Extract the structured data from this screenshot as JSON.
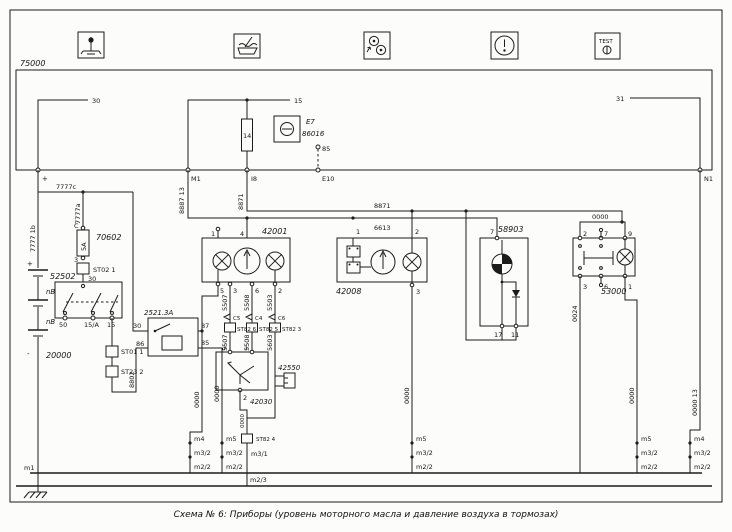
{
  "caption": "Схема № 6: Приборы (уровень моторного масла и давление воздуха в тормозах)",
  "icons": {
    "test_label": "TEST"
  },
  "top": {
    "box_id": "75000",
    "w30": "30",
    "w15": "15",
    "w31": "31",
    "fuse14": "14",
    "e7": "E7",
    "e7_code": "86016",
    "e7_pin": "85",
    "t_plus": "+",
    "t_m1": "M1",
    "t_i8": "I8",
    "t_e10": "E10",
    "t_n1": "N1"
  },
  "wires": {
    "rail": "7777c",
    "rail_left": "7777 1b",
    "rail_right": "7777a",
    "w8887": "8887 13",
    "w8871v": "8871",
    "w8871": "8871",
    "w6613": "6613",
    "w8802": "8802",
    "w0024": "0024",
    "right0000": "0000 13",
    "gnd": "0000"
  },
  "fuse70602": {
    "id": "70602",
    "amp": "5A",
    "c": "C",
    "p3": "3",
    "st02": "ST02 1",
    "p30": "30"
  },
  "sw52502": {
    "id": "52502",
    "p50": "50",
    "p15a": "15/A",
    "p15": "15",
    "st01": "ST01 1",
    "st23": "ST23 2"
  },
  "battery": {
    "id": "20000",
    "plus": "+",
    "minus": "-",
    "nb": "nB"
  },
  "relay": {
    "id": "2521.3A",
    "p30": "30",
    "p87": "87",
    "p86": "86",
    "p85": "85"
  },
  "cl42001": {
    "id": "42001",
    "p1": "1",
    "p4": "4",
    "p5": "5",
    "p3": "3",
    "p6": "6",
    "p2": "2"
  },
  "cols": {
    "w5507": "5507",
    "w5508": "5508",
    "w5503": "5503",
    "w5603": "5603",
    "c5": "C5",
    "c4": "C4",
    "c6": "C6",
    "st6": "ST82 6",
    "st5": "ST82 5",
    "st3": "ST82 3"
  },
  "s42030": {
    "id": "42030",
    "p3": "3",
    "p1": "1",
    "p2": "2"
  },
  "c42550": {
    "id": "42550"
  },
  "g42008": {
    "id": "42008",
    "p1": "1",
    "p2": "2",
    "p3": "3"
  },
  "b58903": {
    "id": "58903",
    "p7": "7",
    "p17": "17",
    "p11": "11"
  },
  "sw53000": {
    "id": "53000",
    "p2": "2",
    "p7": "7",
    "p9": "9",
    "p3": "3",
    "p6": "6",
    "p1": "1",
    "jumper": "0000"
  },
  "grounds": {
    "m1": "m1",
    "g1": [
      "m4",
      "m3/2",
      "m2/2"
    ],
    "g2": [
      "m5",
      "m3/2",
      "m2/2"
    ],
    "g3_st": "ST82 4",
    "g3_m31": "m3/1",
    "g3_m23": "m2/3",
    "g4": [
      "m5",
      "m3/2",
      "m2/2"
    ],
    "g5": [
      "m5",
      "m3/2",
      "m2/2"
    ],
    "g6": [
      "m4",
      "m3/2",
      "m2/2"
    ]
  }
}
